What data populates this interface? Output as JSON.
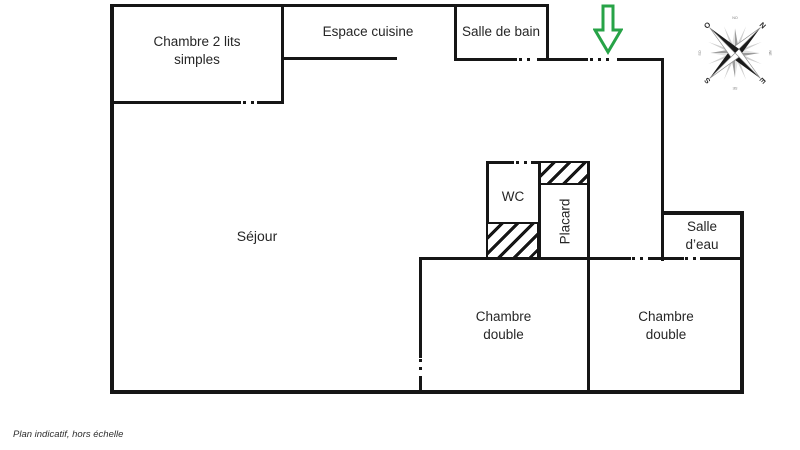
{
  "colors": {
    "wall": "#161616",
    "text": "#262626",
    "arrow_green": "#27a347",
    "compass_dark": "#1a1a1a",
    "compass_gray": "#9c9c9c"
  },
  "rooms": {
    "chambre_simples": {
      "line1": "Chambre 2 lits",
      "line2": "simples"
    },
    "cuisine": {
      "label": "Espace cuisine"
    },
    "salle_de_bain": {
      "label": "Salle de bain"
    },
    "sejour": {
      "label": "Séjour"
    },
    "wc": {
      "label": "WC"
    },
    "placard": {
      "label": "Placard"
    },
    "salle_eau": {
      "line1": "Salle",
      "line2": "d’eau"
    },
    "chambre_double_left": {
      "line1": "Chambre",
      "line2": "double"
    },
    "chambre_double_right": {
      "line1": "Chambre",
      "line2": "double"
    }
  },
  "compass": {
    "icon": "compass-rose-icon",
    "n": "N",
    "e": "E",
    "s": "S",
    "o": "O",
    "no": "NO",
    "ne": "NE",
    "se": "SE",
    "so": "SO"
  },
  "entrance": {
    "icon": "entrance-arrow-icon"
  },
  "footnote": "Plan indicatif, hors échelle"
}
